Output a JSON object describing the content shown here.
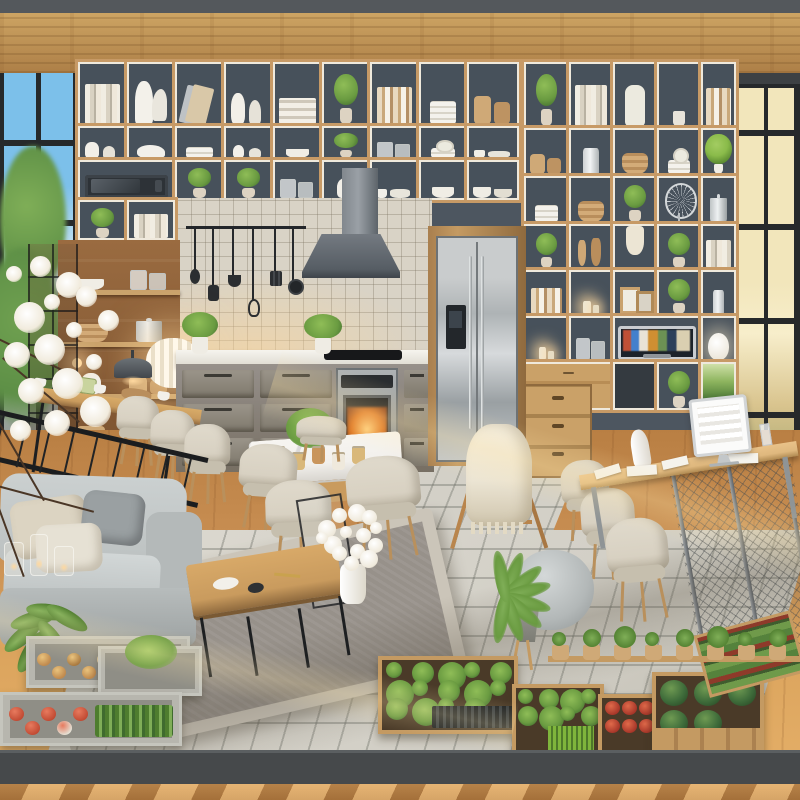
{
  "scene": {
    "label": "sunlit open-plan eco loft interior with modular cube shelving, kitchen, dining nook, lounge sofa, home-office desk and indoor vegetable planters",
    "time_of_day": "day"
  },
  "palette": {
    "top_band": "#54585c",
    "ceiling_light": "#cda463",
    "ceiling_dark": "#ad7f47",
    "wall": "#4d5660",
    "cell_back": "#47515b",
    "shelf_wood": "#c79a66",
    "shelf_edge": "#efe9dc",
    "sky": "#7cc0ea",
    "sky_low": "#c6e2f2",
    "foliage": "#5d8f46",
    "foliage_light": "#7fae57",
    "frame_black": "#26292b",
    "warm_glass": "#f2e6bb",
    "warm_glass_deep": "#d9c48e",
    "tile_wall": "#d9d3c6",
    "hood": "#6f767d",
    "cabinet": "#8b857a",
    "counter": "#f1eee7",
    "steel": "#b9bcbd",
    "oven_glow": "#e0761f",
    "wood_floor": "#c98f53",
    "tile_floor": "#d3d0c7",
    "rug": "#97918a",
    "rug_border": "#cbc5b9",
    "sofa": "#bcc1c1",
    "pillow_beige": "#dcd4c2",
    "pillow_gray": "#9aa0a2",
    "chair_beige": "#d8d1c2",
    "wood_furn": "#c99b5e",
    "wood_light": "#dfb87e",
    "marble": "#f2f0ec",
    "blanket": "#ece5d4",
    "plant_green": "#6a9b41",
    "plant_dark": "#3f6b2e",
    "planter_wood": "#c49a62",
    "concrete": "#b7b6ae",
    "tomato": "#c14a33",
    "onion": "#c08a4e",
    "cabbage": "#3e6b3a",
    "red_leaf": "#8e3a2a",
    "platform": "#46494b",
    "glow": "#ffd9a0",
    "tv_bezel": "#c9ccd0",
    "dark_nook": "#343a40"
  },
  "shelves": {
    "left_rows": [
      {
        "cells": [
          "books",
          "pitcher",
          "lean-book",
          "vases",
          "big-books",
          "plant",
          "books2",
          "dishes",
          "boxes"
        ]
      },
      {
        "cells": [
          "vases",
          "bird",
          "dishes",
          "figurines",
          "bowl",
          "plant",
          "jars",
          "plates",
          "cups"
        ]
      },
      {
        "cells": [
          "microwave:2",
          "plant",
          "plant",
          "jars",
          "vase",
          "cups",
          "bowl",
          "bowls"
        ]
      },
      {
        "cells": [
          "plant",
          "books"
        ]
      }
    ],
    "right_rows": [
      {
        "cells": [
          "plant",
          "books",
          "bin",
          "greens",
          "books2"
        ]
      },
      {
        "cells": [
          "boxes",
          "jar",
          "basket",
          "plates",
          "topiary"
        ]
      },
      {
        "cells": [
          "dishes",
          "basket",
          "plant",
          "fan",
          "pot"
        ]
      },
      {
        "cells": [
          "plant",
          "hooks",
          "towel",
          "plant",
          "books"
        ]
      },
      {
        "cells": [
          "books2",
          "candle",
          "frames",
          "plant",
          "jar"
        ]
      },
      {
        "cells": [
          "candle",
          "jars",
          "tv:2",
          "gourd"
        ]
      },
      {
        "cells": [
          "wood-drawers:2",
          "dark",
          "plant",
          "garden"
        ]
      }
    ]
  },
  "kitchen": {
    "utensils": [
      {
        "kind": "spoon",
        "len": 56
      },
      {
        "kind": "spatula",
        "len": 72
      },
      {
        "kind": "ladle",
        "len": 62
      },
      {
        "kind": "whisk",
        "len": 86
      },
      {
        "kind": "turner",
        "len": 58
      },
      {
        "kind": "pan",
        "len": 66
      }
    ],
    "counter_plants": 2,
    "oven_lit": true
  },
  "pantry": {
    "rows": [
      [
        "bowl",
        "jars"
      ],
      [
        "basket",
        "pot"
      ],
      [
        "vase",
        "boxes"
      ],
      [
        "box",
        "cups"
      ]
    ]
  },
  "dining": {
    "jar_colors": [
      "#e7dfcf",
      "#d9b87a",
      "#c9955c",
      "#efe9dc",
      "#d9b87a"
    ]
  },
  "planters_left": {
    "tray1_produce": [
      "onion",
      "onion",
      "potato",
      "onion",
      "garlic",
      "onion"
    ],
    "tray2": "seedling",
    "tray3_produce": [
      "tomato",
      "tomato",
      "tomato",
      "radish",
      "tomato"
    ]
  },
  "planters_right": {
    "ledge_pots": 8,
    "boxA": "mixed-herbs",
    "boxB": "herbs-wheatgrass",
    "boxC": "red-flowers",
    "boxD_cabbages": 5,
    "side_rows": "lettuce-and-red-leaf"
  },
  "blossom": {
    "flowers": 16,
    "branches": 5
  },
  "tv_mosaic": [
    "#b5533c",
    "#4a7fc1",
    "#e8e3d8",
    "#c8903f",
    "#6f8f5a",
    "#2e3f56"
  ]
}
